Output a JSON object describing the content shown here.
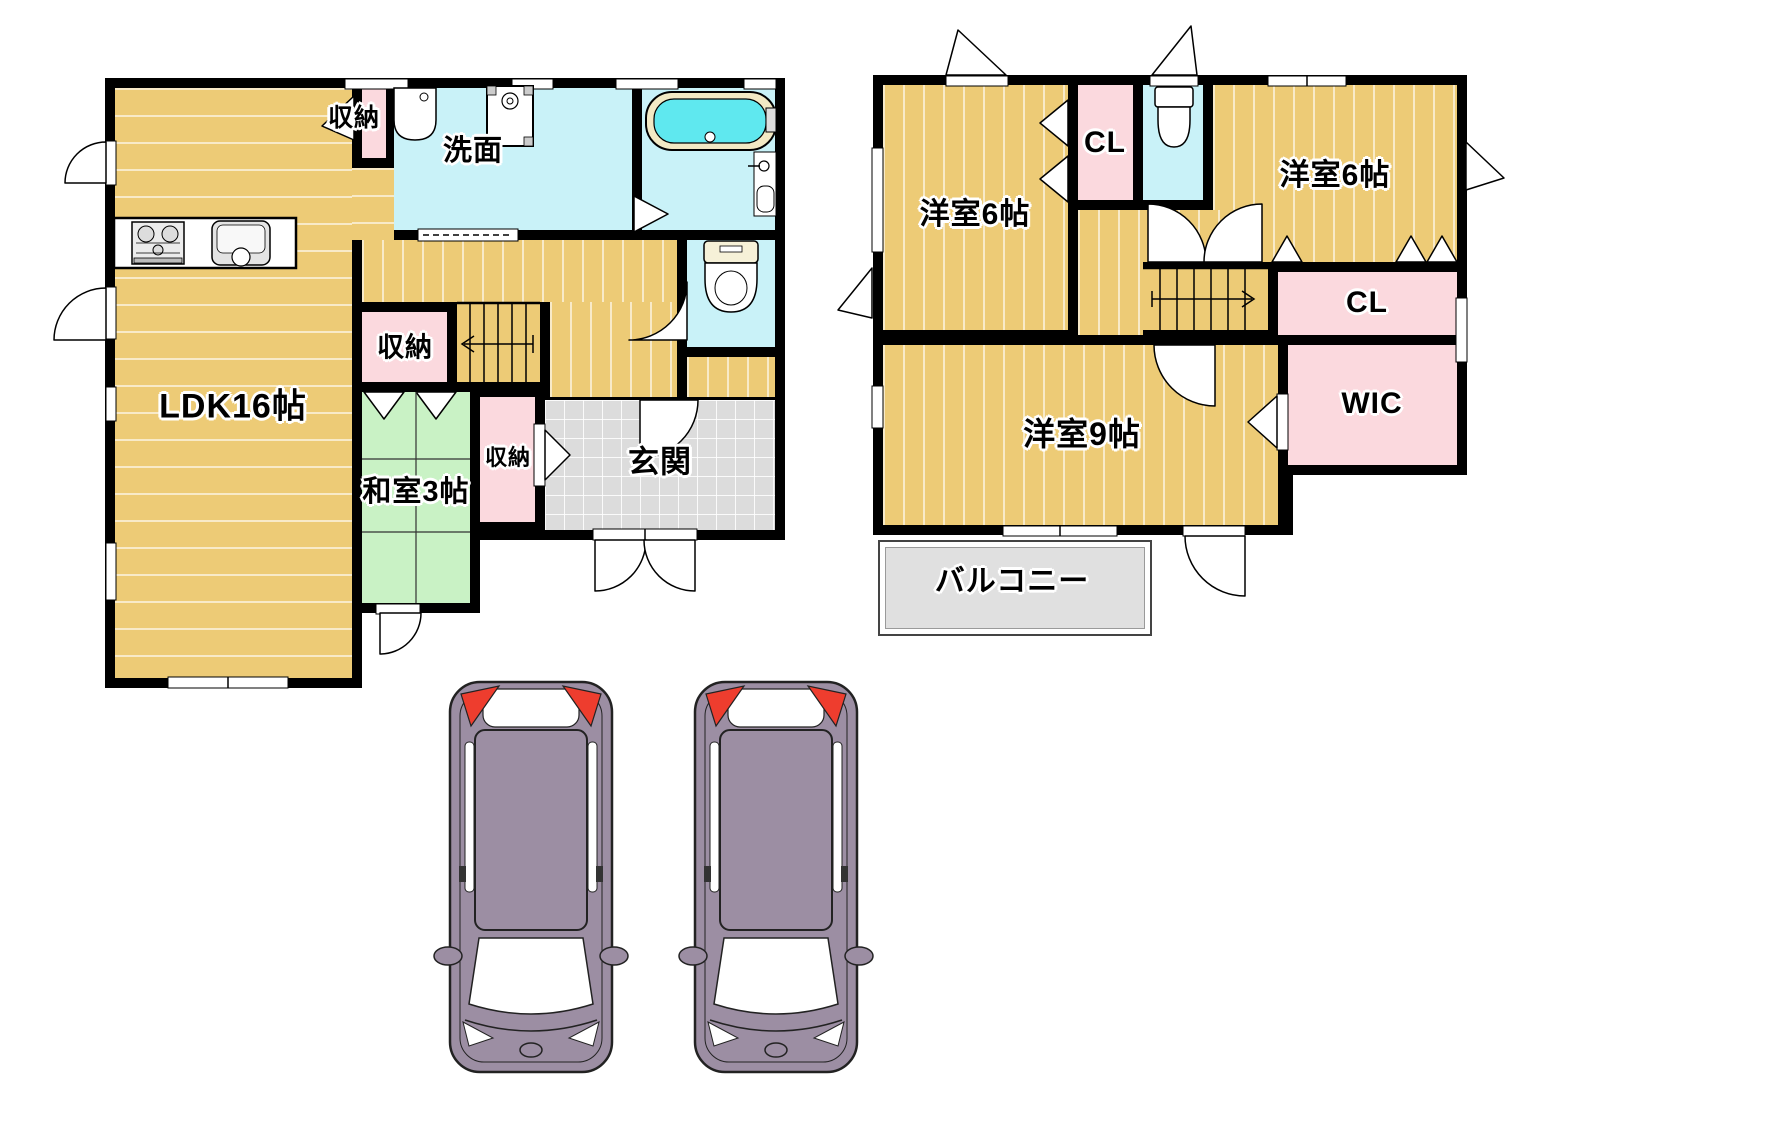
{
  "floor1": {
    "labels": {
      "ldk": "LDK16帖",
      "closet_top": "収納",
      "washroom": "洗面",
      "closet_hall": "収納",
      "washitsu": "和室3帖",
      "closet_entry": "収納",
      "entrance": "玄関"
    }
  },
  "floor2": {
    "labels": {
      "bedroom6_left": "洋室6帖",
      "closet1": "CL",
      "bedroom6_right": "洋室6帖",
      "closet2": "CL",
      "wic": "WIC",
      "bedroom9": "洋室9帖",
      "balcony": "バルコニー"
    }
  },
  "colors": {
    "wall": "#000000",
    "wood_floor": "#EDCB76",
    "tatami_green": "#C9F2C5",
    "closet_pink": "#FBD9DE",
    "water_cyan": "#C9F2F8",
    "tub_water": "#5FE8EF",
    "tub_rim": "#F2E9C4",
    "entrance_gray": "#DCDCDC",
    "balcony_gray": "#E0E0E0",
    "car_body": "#9C8EA3",
    "car_tail_red": "#EE3D2E"
  }
}
